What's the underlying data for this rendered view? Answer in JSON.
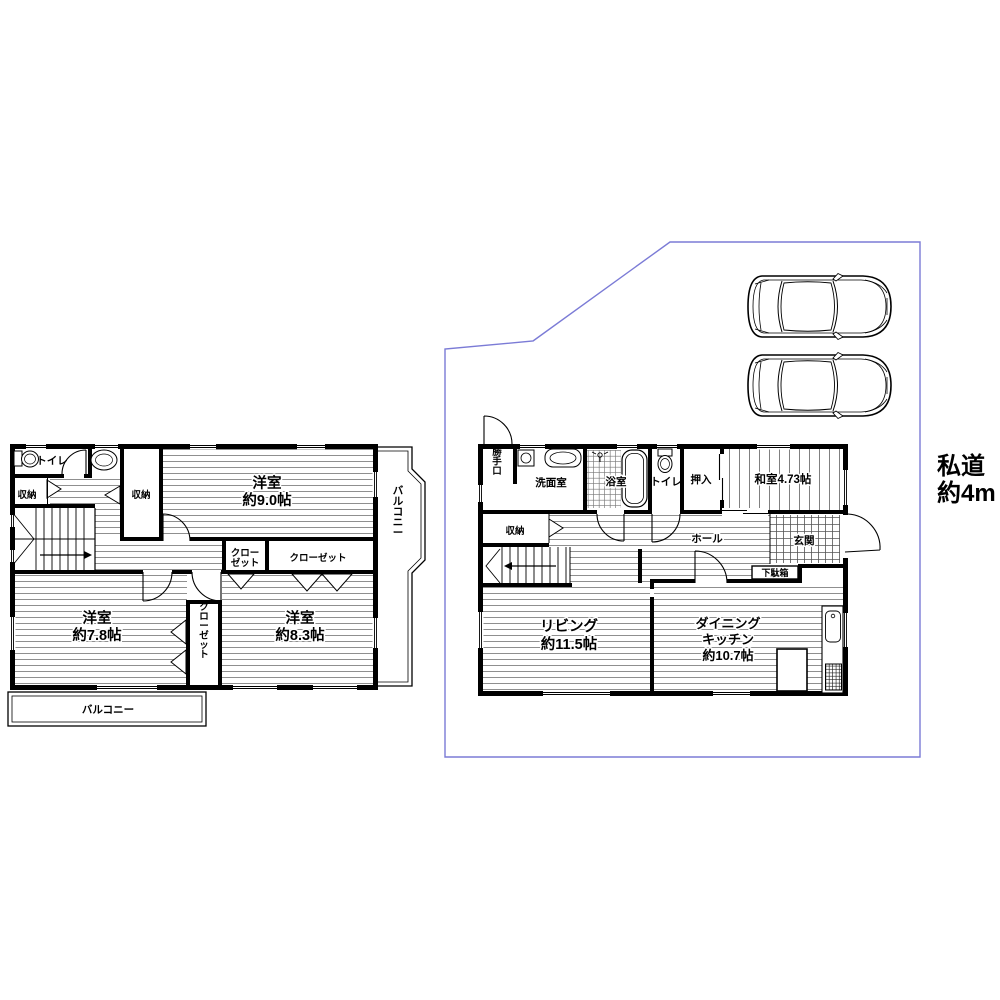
{
  "colors": {
    "boundary": "#7b7bd6",
    "wall": "#000000"
  },
  "site": {
    "road_label_line1": "私道",
    "road_label_line2": "約4m",
    "car_count": 2
  },
  "floor2": {
    "toilet": "トイレ",
    "storage_left": "収納",
    "storage_mid": "収納",
    "bedroom9_name": "洋室",
    "bedroom9_size": "約9.0帖",
    "closet_small_line1": "クロー",
    "closet_small_line2": "ゼット",
    "closet_wide": "クローゼット",
    "closet_tall": "クローゼット",
    "bedroom78_name": "洋室",
    "bedroom78_size": "約7.8帖",
    "bedroom83_name": "洋室",
    "bedroom83_size": "約8.3帖",
    "balcony_side": "バルコニー",
    "balcony_bottom": "バルコニー"
  },
  "floor1": {
    "back_door": "勝手口",
    "washroom": "洗面室",
    "bathroom": "浴室",
    "toilet": "トイレ",
    "oshiire": "押入",
    "japanese_room": "和室4.73帖",
    "storage": "収納",
    "hall": "ホール",
    "entrance": "玄関",
    "shoe_cabinet": "下駄箱",
    "living_name": "リビング",
    "living_size": "約11.5帖",
    "dk_line1": "ダイニング",
    "dk_line2": "キッチン",
    "dk_line3": "約10.7帖"
  }
}
